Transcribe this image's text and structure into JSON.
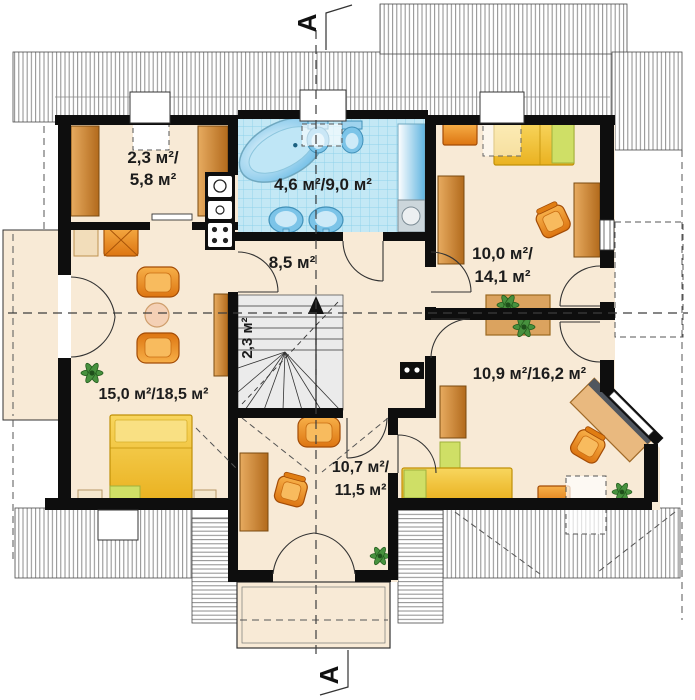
{
  "plan": {
    "type": "attic-floor-plan",
    "section": {
      "marker": "A"
    },
    "rooms": {
      "wardrobe": {
        "line1": "2,3 м²/",
        "line2": "5,8 м²"
      },
      "bathroom": {
        "label": "4,6 м²/9,0 м²"
      },
      "hall": {
        "label": "8,5 м²"
      },
      "staircase": {
        "label": "2,3 м²"
      },
      "living_room": {
        "label": "15,0 м²/18,5 м²"
      },
      "bedroom_top_right": {
        "line1": "10,0 м²/",
        "line2": "14,1 м²"
      },
      "bedroom_bottom_right": {
        "label": "10,9 м²/16,2 м²"
      },
      "room_bottom_middle": {
        "line1": "10,7 м²/",
        "line2": "11,5 м²"
      }
    },
    "colors": {
      "floor": "#f8ead6",
      "tile_blue": "#c3e8f5",
      "wall": "#0e0e0e",
      "furniture_orange": "#e8871e",
      "bed_yellow": "#f0c335",
      "wood_brown": "#c9803a",
      "accent_green": "#cfdf66",
      "water_blue": "#57b2e2"
    }
  }
}
